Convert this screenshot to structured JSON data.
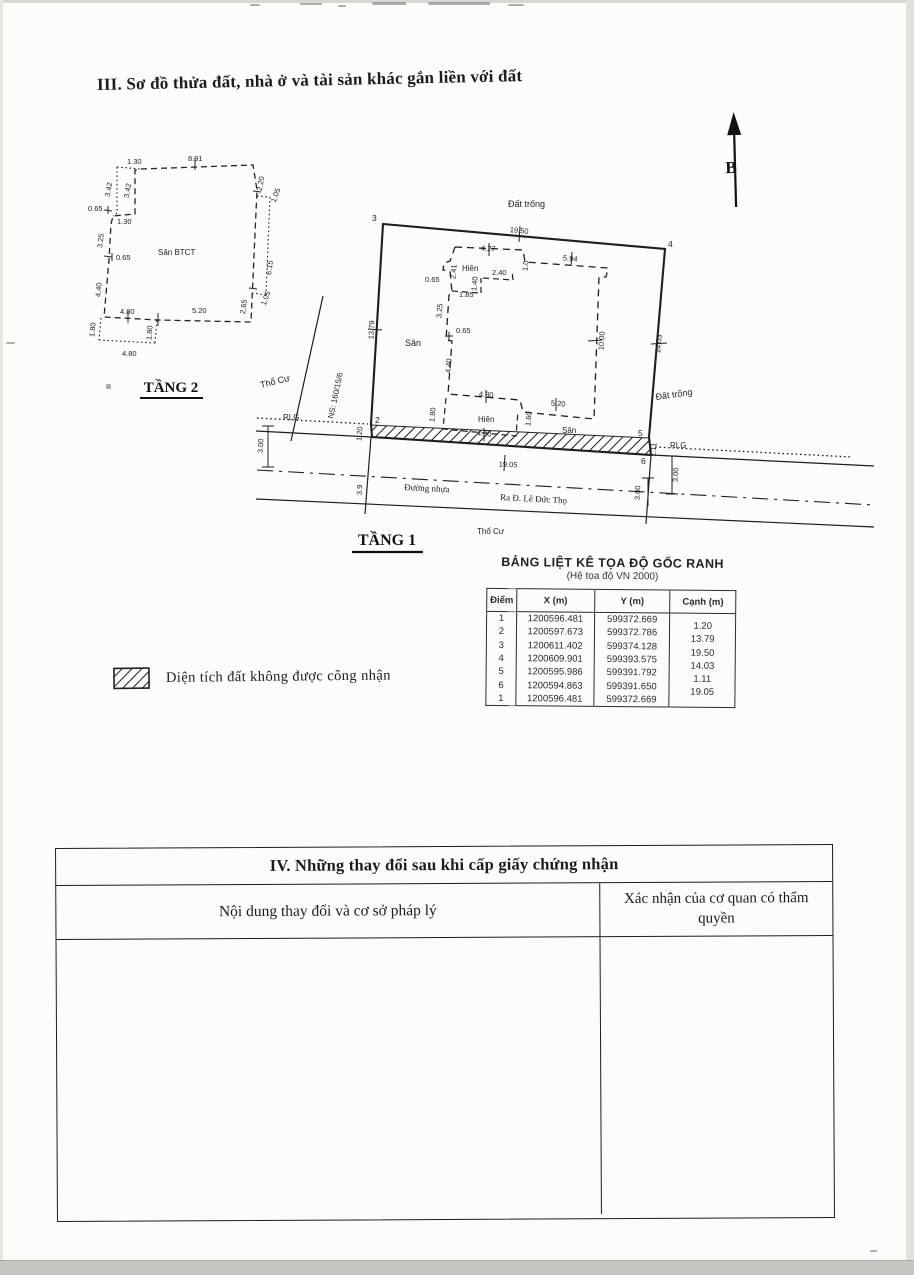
{
  "page": {
    "section3_title": "III. Sơ đồ thửa đất, nhà ở và tài sản khác gắn liền với đất",
    "north_label": "B"
  },
  "floor2": {
    "title": "TẦNG 2",
    "center_label": "Sân BTCT",
    "dims": {
      "t130": "1.30",
      "t891": "8.91",
      "l342o": "3.42",
      "l342i": "3.42",
      "l065a": "0.65",
      "l130": "1.30",
      "l325": "3.25",
      "l065b": "0.65",
      "l440": "4.40",
      "l180": "1.80",
      "b480i": "4.80",
      "b520": "5.20",
      "n180": "1.80",
      "b480o": "4.80",
      "r220": "2.20",
      "r105a": "1.05",
      "r615": "6.15",
      "r105b": "1.05",
      "r265": "2.65"
    }
  },
  "floor1": {
    "title": "TẦNG 1",
    "labels": {
      "top_area": "Đất trống",
      "right_area": "Đất trống",
      "left_area": "Thổ Cư",
      "bottom_area": "Thổ Cư",
      "yard": "Sân",
      "yard_bottom": "Sân",
      "porch_top": "Hiên",
      "porch_bottom": "Hiên",
      "lane": "NS: 160/15/6",
      "rlg_left": "RLG",
      "rlg_right": "RLG",
      "road": "Đường nhựa",
      "road_dest": "Ra Đ. Lê Đức Thọ"
    },
    "corners": {
      "p2": "2",
      "p3": "3",
      "p4": "4",
      "p5": "5",
      "p6": "6"
    },
    "dims": {
      "top": "19.50",
      "left": "13.79",
      "right": "14.03",
      "bottom": "19.05",
      "inner_right": "10.00",
      "top1": "4.27",
      "top2": "5.94",
      "step": "1.0",
      "v241": "2.41",
      "j065a": "0.65",
      "h185": "1.85",
      "v140": "1.40",
      "h240": "2.40",
      "v325": "3.25",
      "j065b": "0.65",
      "v440": "4.40",
      "v180": "1.80",
      "h480a": "4.80",
      "h520": "5.20",
      "v160": "1.60",
      "h480b": "4.80",
      "e12": "1.20",
      "e56": "1.11",
      "s300l": "3.00",
      "s300r1": "3.00",
      "s300r2": "3.00",
      "road39": "3.9"
    }
  },
  "legend": {
    "not_recognized": "Diện tích đất không được công nhận"
  },
  "coord_table": {
    "title": "BẢNG LIỆT KÊ TỌA ĐỘ GỐC RANH",
    "subtitle": "(Hệ tọa độ VN 2000)",
    "headers": [
      "Điểm",
      "X (m)",
      "Y (m)",
      "Cạnh (m)"
    ],
    "points": [
      {
        "diem": "1",
        "x": "1200596.481",
        "y": "599372.669"
      },
      {
        "diem": "2",
        "x": "1200597.673",
        "y": "599372.786"
      },
      {
        "diem": "3",
        "x": "1200611.402",
        "y": "599374.128"
      },
      {
        "diem": "4",
        "x": "1200609.901",
        "y": "599393.575"
      },
      {
        "diem": "5",
        "x": "1200595.986",
        "y": "599391.792"
      },
      {
        "diem": "6",
        "x": "1200594.863",
        "y": "599391.650"
      },
      {
        "diem": "1",
        "x": "1200596.481",
        "y": "599372.669"
      }
    ],
    "edges": [
      "1.20",
      "13.79",
      "19.50",
      "14.03",
      "1.11",
      "19.05"
    ]
  },
  "section4": {
    "title": "IV. Những thay đổi sau khi cấp giấy chứng nhận",
    "col_left": "Nội dung thay đổi và cơ sở pháp lý",
    "col_right": "Xác nhận của cơ quan có thẩm quyền"
  }
}
